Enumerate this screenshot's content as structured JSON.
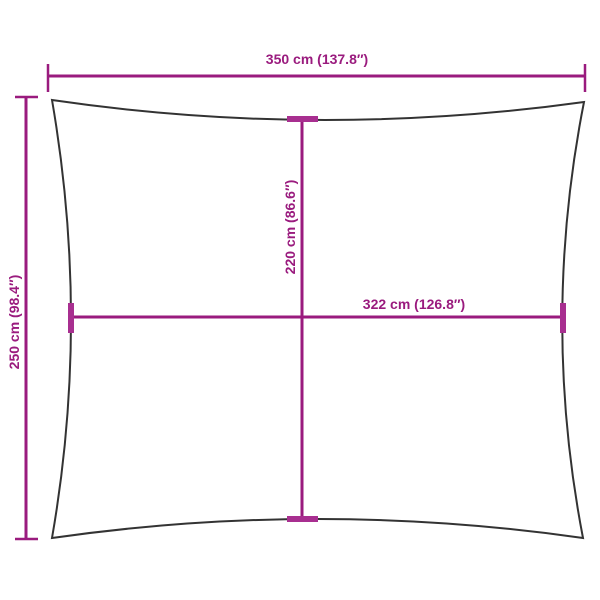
{
  "colors": {
    "dimension_line": "#9a1b7e",
    "tick_fill": "#a82f90",
    "sail_outline": "#333333",
    "background": "#ffffff"
  },
  "dimensions": {
    "width_total": {
      "label": "350 cm (137.8″)"
    },
    "height_total": {
      "label": "250 cm (98.4″)"
    },
    "height_inner": {
      "label": "220 cm (86.6″)"
    },
    "width_inner": {
      "label": "322 cm (126.8″)"
    }
  }
}
